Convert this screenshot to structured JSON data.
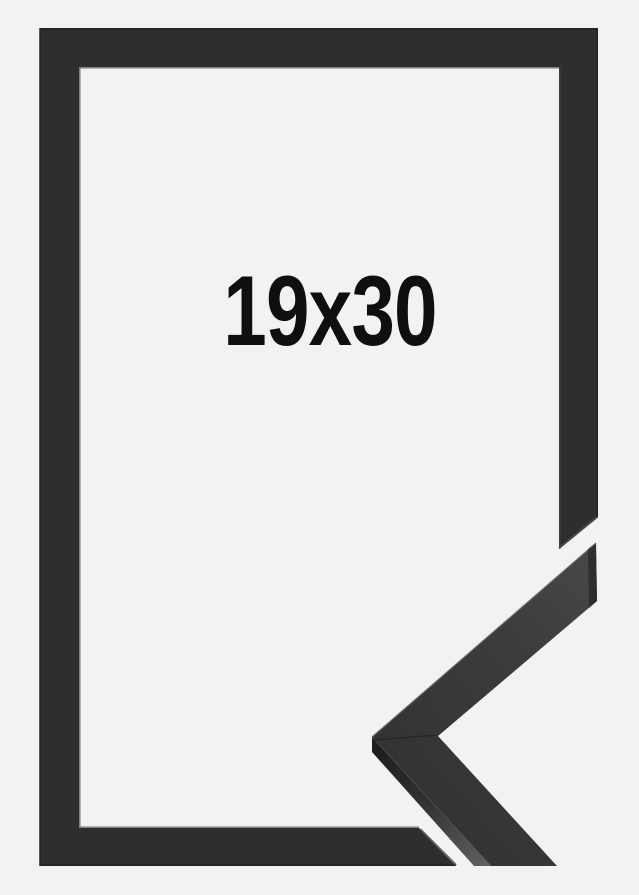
{
  "product": {
    "size_label": "19x30"
  },
  "scene": {
    "subject": "black picture frame, portrait orientation",
    "detail": "mitered corner profile sample overlapping cut-away bottom-right corner"
  },
  "colors": {
    "background": "#f2f2f3",
    "frame": "#2e2e2e",
    "frame_outer_edge": "#202020",
    "frame_inner_lip": "#474747",
    "frame_cut_face": "#4a4a4a",
    "sample_face_dark": "#343434",
    "sample_face_light": "#474747",
    "sample_side_dark": "#1f1f1f",
    "sample_side_light": "#5f5f5f",
    "sample_end_face": "#2b2b2b",
    "label_text": "#0f0f0f"
  }
}
